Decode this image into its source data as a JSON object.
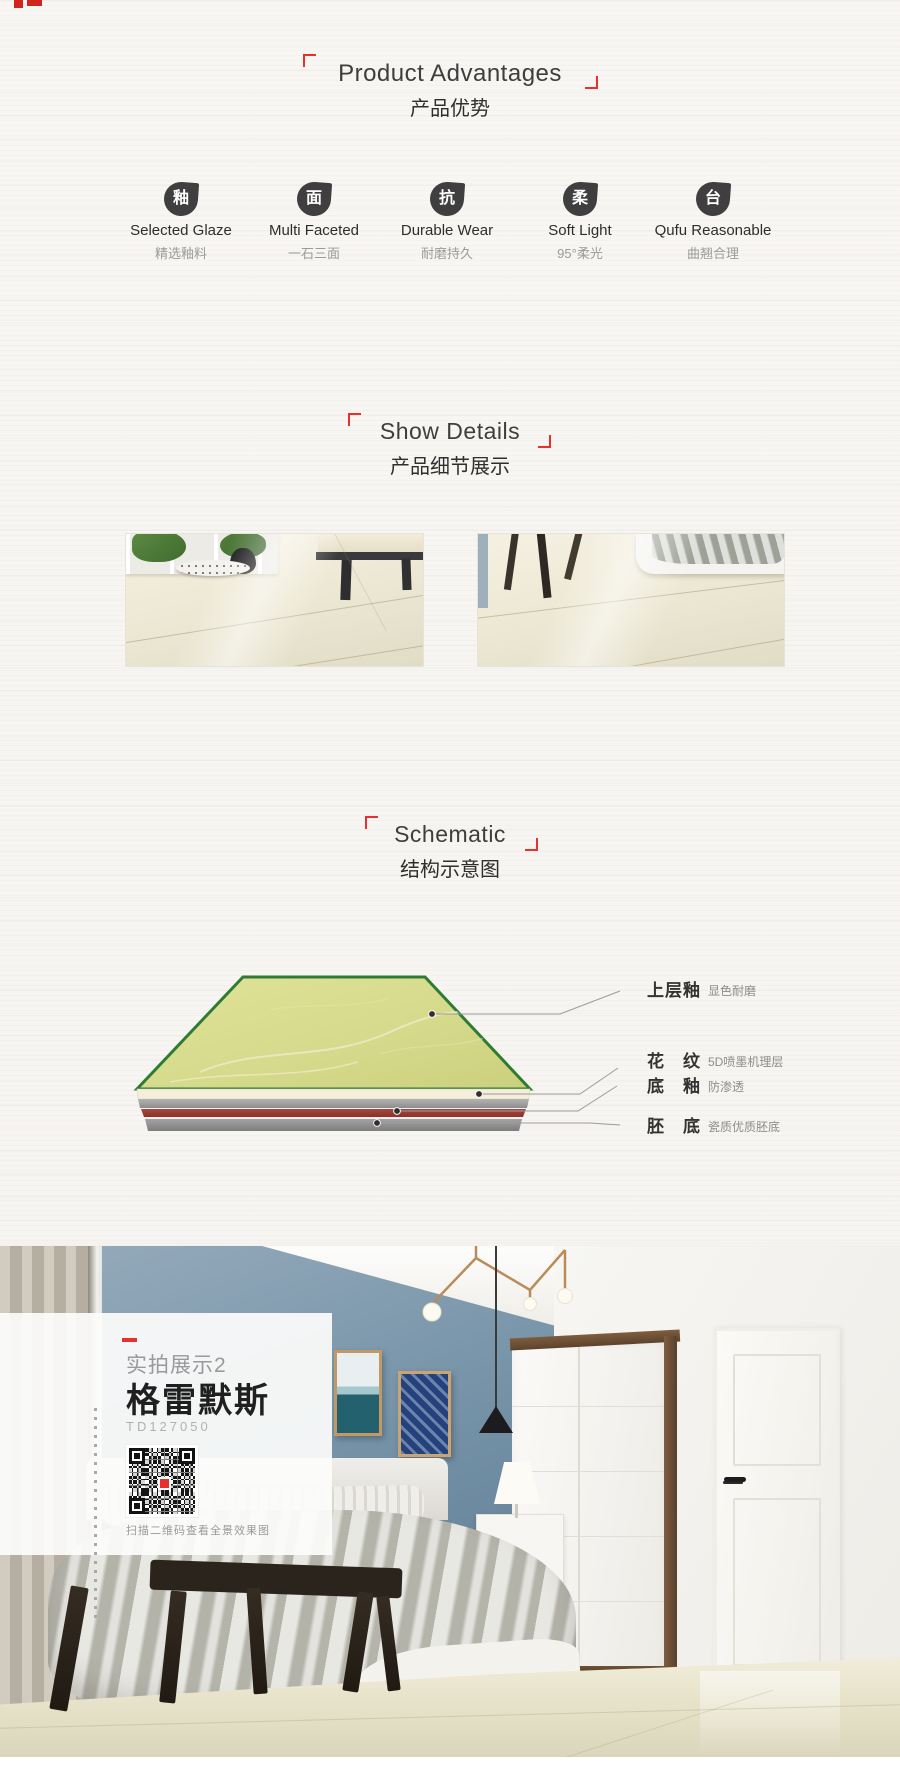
{
  "colors": {
    "accent_red": "#e8312f",
    "tile_green_border": "#2e7c33",
    "tile_surface": "#d6da8c",
    "layer_red": "#9c3a33",
    "layer_gray": "#9a9a9a"
  },
  "advantages": {
    "title": "Product Advantages",
    "subtitle": "产品优势",
    "items": [
      {
        "icon": "釉",
        "label": "Selected Glaze",
        "sublabel": "精选釉料"
      },
      {
        "icon": "面",
        "label": "Multi Faceted",
        "sublabel": "一石三面"
      },
      {
        "icon": "抗",
        "label": "Durable Wear",
        "sublabel": "耐磨持久"
      },
      {
        "icon": "柔",
        "label": "Soft Light",
        "sublabel": "95°柔光"
      },
      {
        "icon": "台",
        "label": "Qufu Reasonable",
        "sublabel": "曲翘合理"
      }
    ]
  },
  "details": {
    "title": "Show Details",
    "subtitle": "产品细节展示"
  },
  "schematic": {
    "title": "Schematic",
    "subtitle": "结构示意图",
    "layers": [
      {
        "name": "上层釉",
        "desc": "显色耐磨"
      },
      {
        "name": "花　纹",
        "desc": "5D喷墨机理层"
      },
      {
        "name": "底　釉",
        "desc": "防渗透"
      },
      {
        "name": "胚　底",
        "desc": "瓷质优质胚底"
      }
    ]
  },
  "showcase": {
    "tag": "实拍展示2",
    "product_name": "格雷默斯",
    "model": "TD127050",
    "qr_caption": "扫描二维码查看全景效果图"
  }
}
